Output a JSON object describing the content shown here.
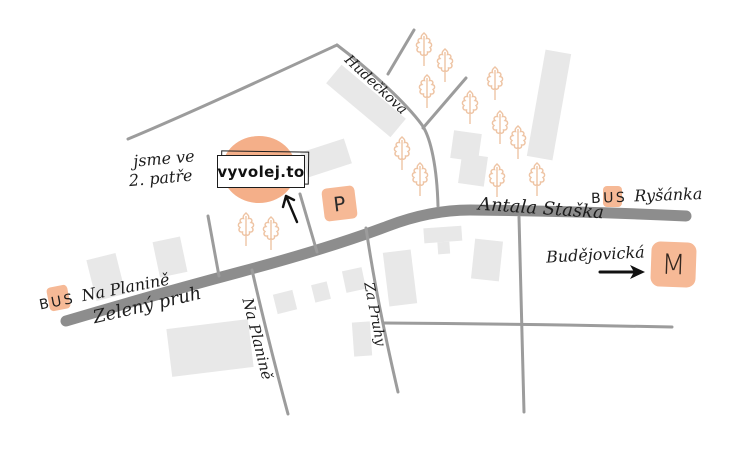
{
  "colors": {
    "accent": "#f6b996",
    "accent_deep": "#f4af89",
    "road": "#8d8d8d",
    "road_thin": "#9c9c9c",
    "building": "#e8e8e8",
    "tree": "#eec4a4",
    "ink": "#1c1c1c"
  },
  "shop": {
    "name": "vyvolej.to",
    "note_line1": "jsme ve",
    "note_line2": "2. patře"
  },
  "parking": {
    "symbol": "P"
  },
  "metro": {
    "symbol": "M",
    "station": "Budějovická"
  },
  "bus_stops": {
    "left": {
      "prefix": "BUS",
      "name": "Na Planině"
    },
    "right": {
      "prefix": "BUS",
      "name": "Ryšánka"
    }
  },
  "streets": {
    "main_southwest": "Zelený pruh",
    "main_northeast": "Antala Staška",
    "north": "Hudečkova",
    "south_left": "Na Planině",
    "south_mid": "Za Pruhy"
  }
}
